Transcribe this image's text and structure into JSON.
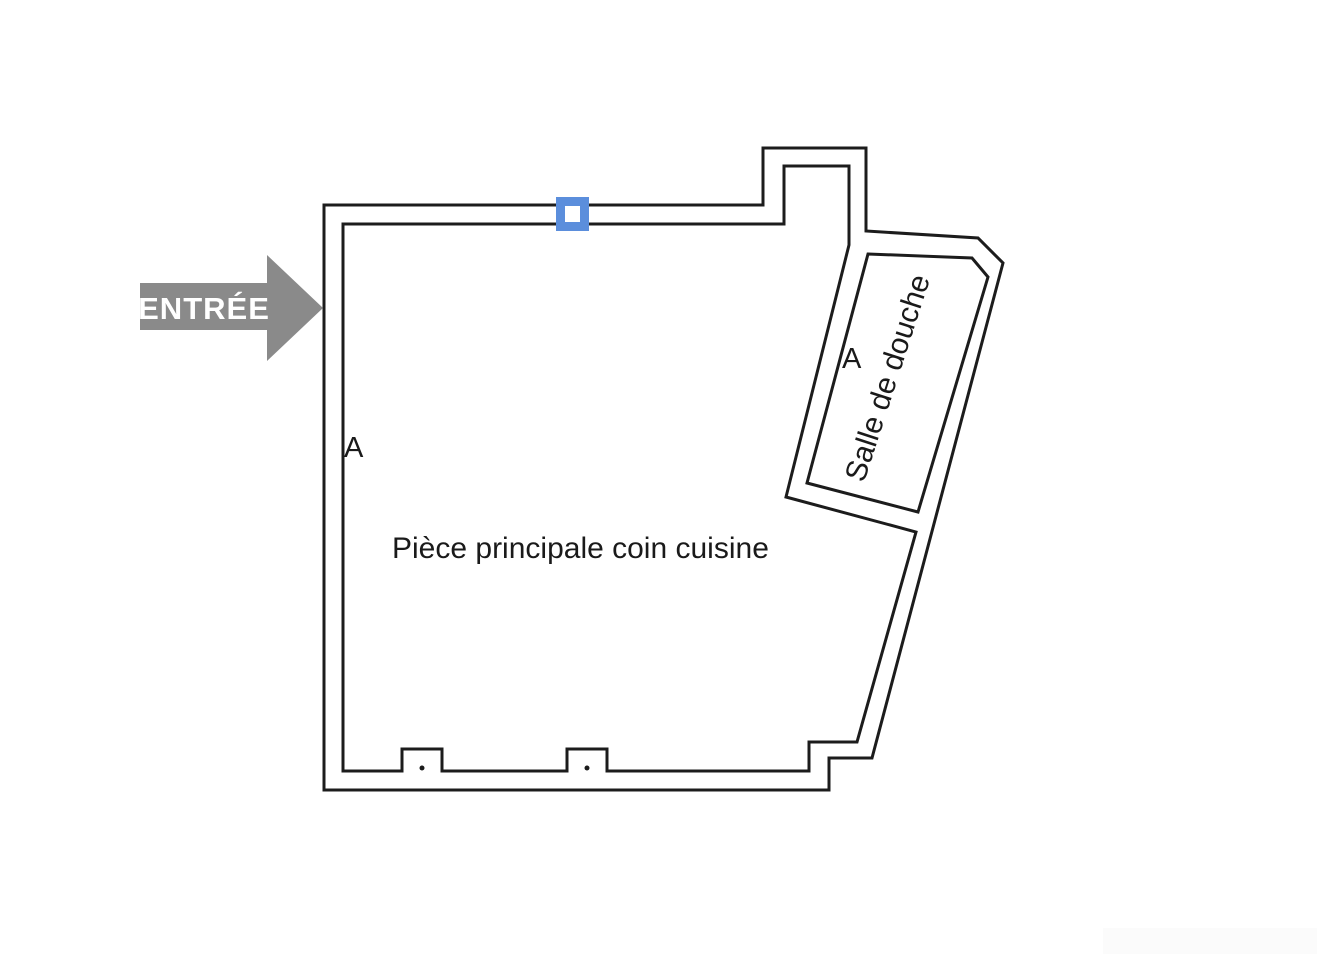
{
  "canvas": {
    "width": 1320,
    "height": 956,
    "background": "#ffffff"
  },
  "colors": {
    "wall_stroke": "#1c1c1c",
    "label_text": "#1a1a1a",
    "arrow_fill": "#8a8a8a",
    "arrow_text": "#ffffff",
    "marker_blue": "#5b8edc",
    "marker_inner": "#ffffff",
    "watermark": "#fbfbfb"
  },
  "entry": {
    "label": "ENTRÉE"
  },
  "rooms": {
    "main": {
      "label": "Pièce principale coin cuisine",
      "section_label": "A"
    },
    "shower": {
      "label": "Salle de douche",
      "section_label": "A"
    }
  }
}
